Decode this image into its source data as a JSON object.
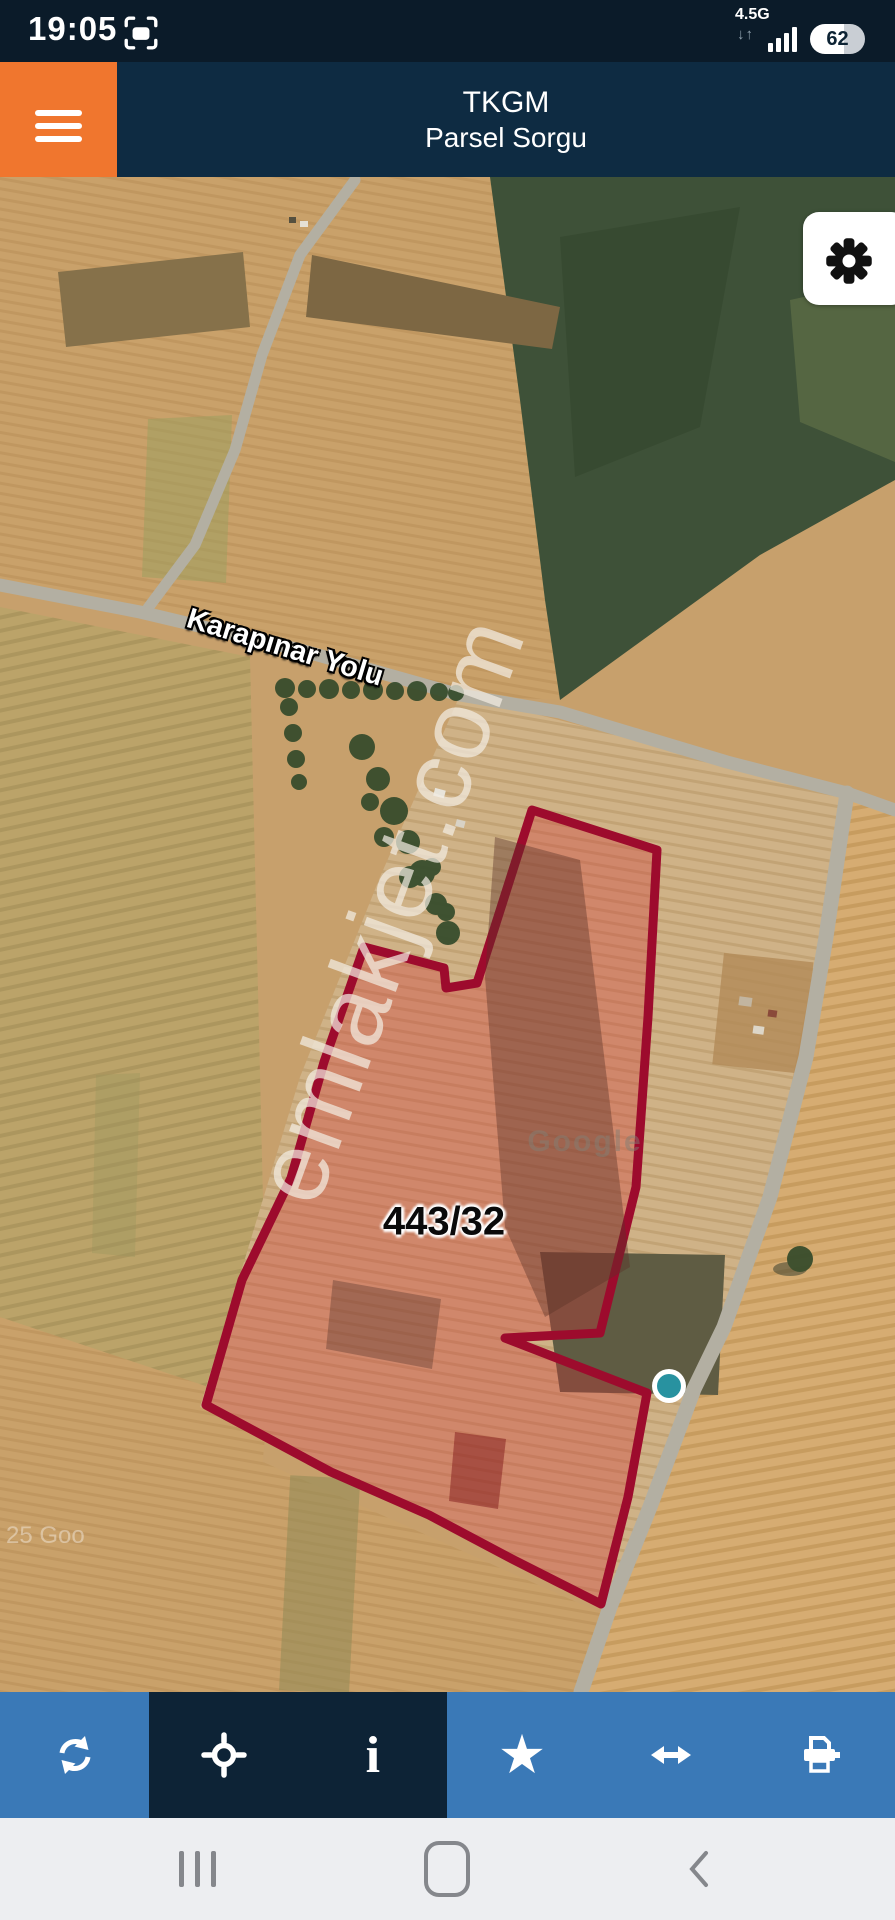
{
  "status_bar": {
    "time": "19:05",
    "network": "4.5G",
    "network_arrows": "↓↑",
    "battery_percent": "62"
  },
  "header": {
    "title_line1": "TKGM",
    "title_line2": "Parsel Sorgu"
  },
  "map": {
    "road_label": "Karapınar Yolu",
    "parcel_label": "443/32",
    "watermark": "emlakjet.com",
    "imagery_watermark": "Google",
    "copyright_fragment": "25 Goo",
    "colors": {
      "parcel_stroke": "#9d0b2d",
      "parcel_fill": "rgba(208,48,52,0.33)",
      "marker_teal": "#2892a0",
      "field_tan": "#c7a06c",
      "field_green": "#3e5138",
      "road_gray": "#b3afa2",
      "accent_orange": "#f0762e",
      "header_navy": "#0e2b42",
      "toolbar_blue": "#3a79b7",
      "toolbar_dark": "#0d2336"
    }
  },
  "toolbar": {
    "buttons": [
      {
        "name": "refresh"
      },
      {
        "name": "locate"
      },
      {
        "name": "info",
        "glyph": "i"
      },
      {
        "name": "favorite",
        "glyph": "★"
      },
      {
        "name": "measure"
      },
      {
        "name": "print"
      }
    ]
  },
  "nav_bar": {
    "items": [
      "recents",
      "home",
      "back"
    ]
  }
}
